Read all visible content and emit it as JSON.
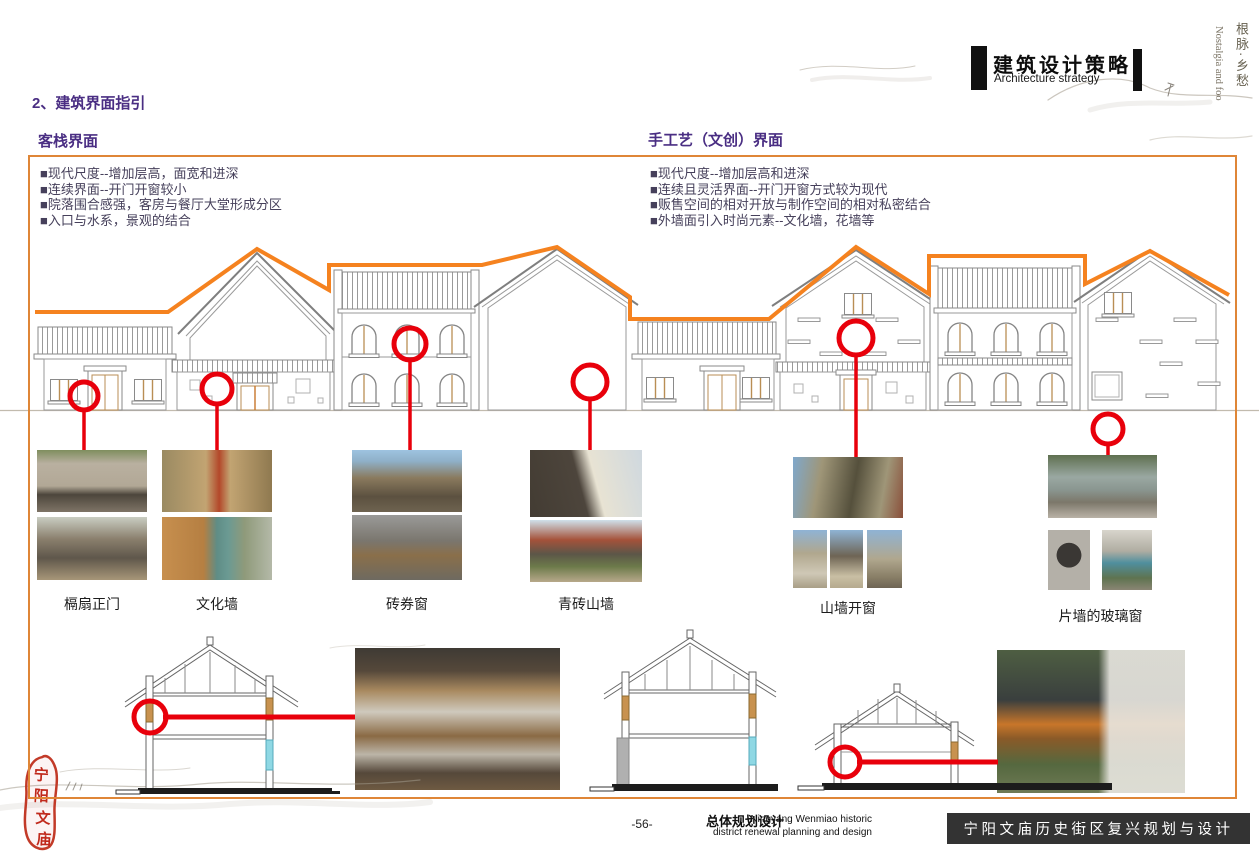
{
  "header": {
    "block_title_cn": "建筑设计策略",
    "block_title_en": "Architecture strategy",
    "side_vertical_cn": "根脉·乡愁",
    "side_vertical_en": "Nostalgia and foo"
  },
  "page_title": "2、建筑界面指引",
  "panels": {
    "inn": {
      "title": "客栈界面",
      "bullets": [
        "■现代尺度--增加层高，面宽和进深",
        "■连续界面--开门开窗较小",
        "■院落围合感强，客房与餐厅大堂形成分区",
        "■入口与水系，景观的结合"
      ]
    },
    "craft": {
      "title": "手工艺（文创）界面",
      "bullets": [
        "■现代尺度--增加层高和进深",
        "■连续且灵活界面--开门开窗方式较为现代",
        "■贩售空间的相对开放与制作空间的相对私密结合",
        "■外墙面引入时尚元素--文化墙，花墙等"
      ]
    }
  },
  "captions": [
    "槅扇正门",
    "文化墙",
    "砖券窗",
    "青砖山墙",
    "山墙开窗",
    "片墙的玻璃窗"
  ],
  "seal_chars": [
    "宁",
    "阳",
    "文",
    "庙"
  ],
  "footer": {
    "page_number": "-56-",
    "plan_title_cn": "总体规划设计",
    "plan_subtitle_en_line1": "Ningyang Wenmiao historic",
    "plan_subtitle_en_line2": "district renewal planning and design",
    "banner_title": "宁阳文庙历史街区复兴规划与设计"
  },
  "colors": {
    "accent_orange": "#F5821F",
    "box_border": "#DF8637",
    "marker_red": "#E8000B",
    "heading_purple": "#4A2E83",
    "banner_bg": "#333333"
  }
}
